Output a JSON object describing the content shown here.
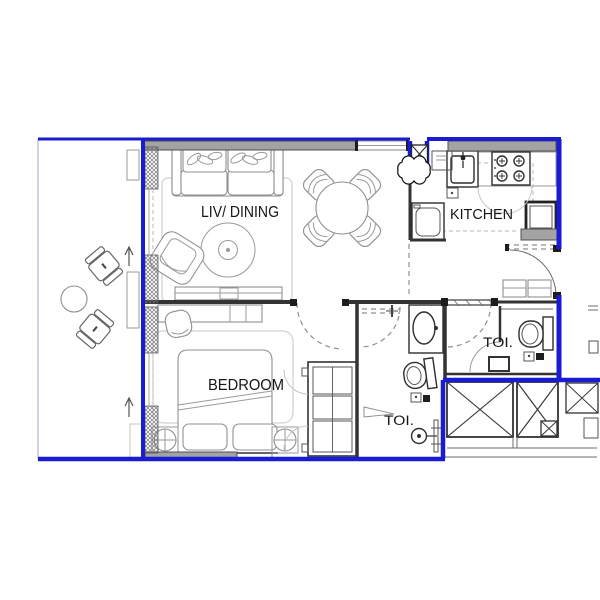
{
  "title": "Apartment unit floor plan",
  "rooms": {
    "living": "LIV/ DINING",
    "kitchen": "KITCHEN",
    "bedroom": "BEDROOM",
    "toilet_right": "TOI.",
    "toilet_bottom": "TOI."
  },
  "icons": {
    "up_arrow": "↑",
    "shaft_cross": "✕"
  },
  "colors": {
    "boundary": "#1b1bd2",
    "wall_fill": "#a3a3a3",
    "line": "#333333",
    "furniture": "#8f8f8f"
  }
}
